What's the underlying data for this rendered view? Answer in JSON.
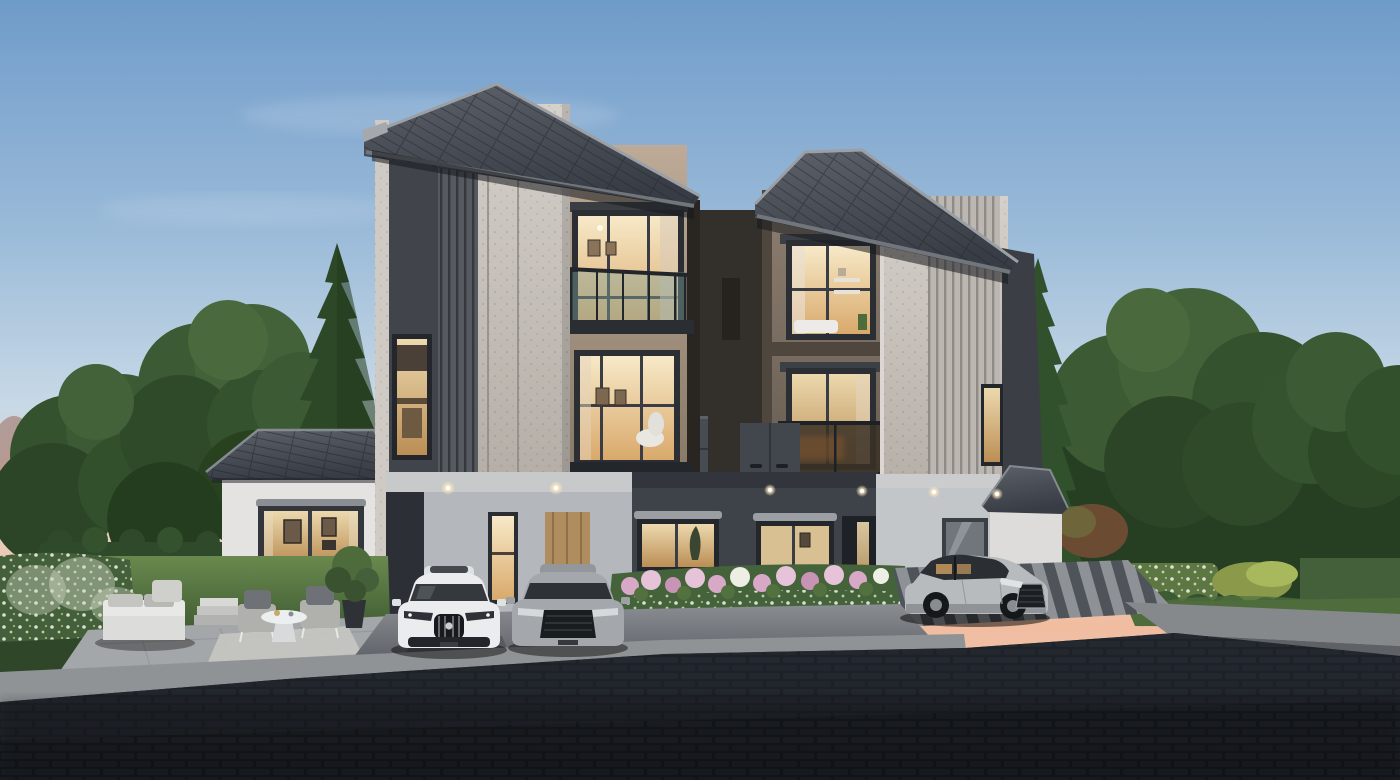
{
  "scene": {
    "description": "Photorealistic dusk rendering of two modern three-storey twin townhouses with warmly lit windows, a single-storey side wing, carport with a white and a grey sedan, a silver sedan on a striped driveway, hydrangea flower bed, garden patio with white outdoor lounge furniture, dense evergreen backdrop and a dark cobblestone street in the foreground",
    "time_of_day": "dusk",
    "labels": {
      "sky": "Dusk sky with pink horizon glow",
      "clouds": "Soft clouds",
      "background_trees": "Dense deciduous and evergreen trees",
      "left_conifer": "Tall conifer tree",
      "right_conifer": "Conifer tree",
      "left_house": "Left three-storey townhouse",
      "right_house": "Right three-storey townhouse",
      "left_wing": "Single-storey wing with lit picture window",
      "right_wing": "Right single-storey wing",
      "carport": "Recessed carport with downlights",
      "entry_door": "Glazed lit entry door",
      "wood_door": "Timber entry door",
      "flower_bed": "Hydrangea flower bed with concrete curb",
      "patio": "Garden patio with outdoor lounge set",
      "sofa": "White outdoor sofa",
      "armchair": "Outdoor armchair",
      "coffee_table": "Round white coffee table",
      "rug": "Outdoor rug",
      "potted_tree": "Potted tree",
      "white_car": "White sports sedan",
      "gray_car": "Grey sedan",
      "silver_car": "Silver sedan on driveway",
      "driveway": "Striped paver driveway",
      "street": "Dark cobblestone street",
      "hedges": "Flowering hedgerows",
      "lawn": "Garden lawn",
      "balcony": "Glass balustrade balcony",
      "downlight": "Recessed soffit downlight"
    }
  },
  "palette": {
    "sky_top": "#6f9bc9",
    "sky_mid": "#c8d9e6",
    "sky_pink": "#f0bda1",
    "roof_light": "#5c616a",
    "roof_dark": "#383c44",
    "fascia": "#969ba2",
    "stucco_light": "#d6d0ca",
    "stucco_dark": "#b3ada6",
    "clad_dark": "#54585e",
    "panel_dark": "#41454b",
    "beige_light": "#bdaa97",
    "beige_dark": "#847663",
    "bronze_light": "#8d7e70",
    "bronze_dark": "#645a50",
    "charcoal": "#3d4248",
    "white_wall": "#e4e3e1",
    "porch_gray": "#c3c6c9",
    "window_frame": "#2b2f34",
    "glow_light": "#f7e9c8",
    "glow_deep": "#d9a96b",
    "glass_cool": "#6e747b",
    "balcony_teal": "#7fa39b",
    "tree_dark": "#2b4526",
    "tree_mid": "#3c5a33",
    "tree_light": "#50703f",
    "lawn_light": "#6a894e",
    "lawn_dark": "#3e5a32",
    "hedge": "#45623a",
    "flower_pink": "#d8a8c7",
    "flower_pink_light": "#e7c3d9",
    "flower_white": "#edeee4",
    "paver": "#a3a7aa",
    "apron_light": "#8a8e93",
    "curb": "#9aa0a4",
    "drive_light": "#8e9296",
    "drive_dark": "#4e545a",
    "road_top": "#272c33",
    "road_bottom": "#0e1115",
    "car_white": "#eaeced",
    "car_gray": "#a4a7ab",
    "car_silver": "#b8bbbe"
  }
}
